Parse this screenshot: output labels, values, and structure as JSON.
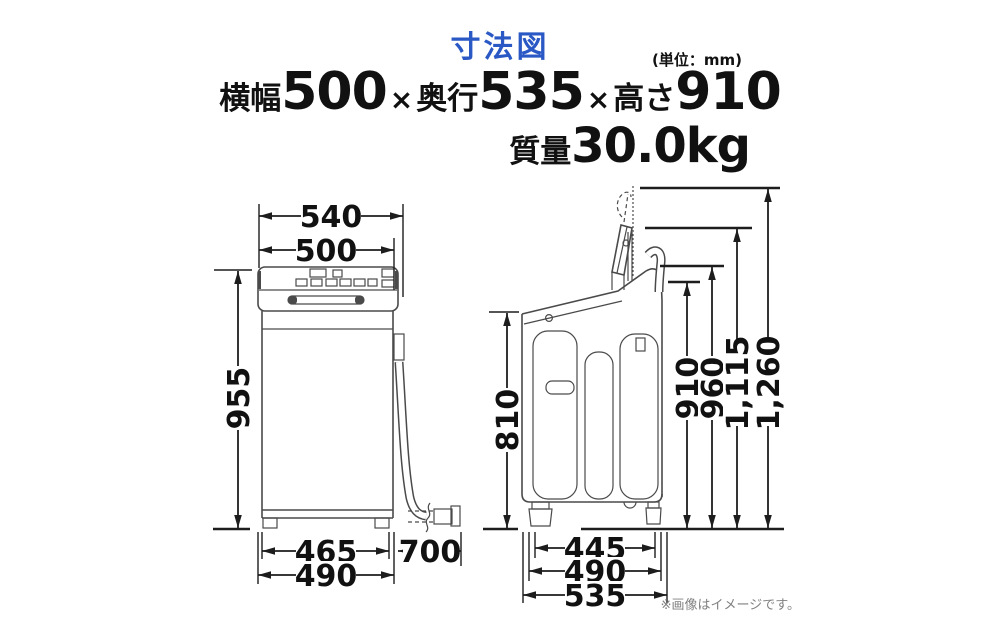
{
  "header": {
    "title": "寸法図",
    "unit_note": "(単位：mm)",
    "spec": {
      "width_label": "横幅",
      "width_value": "500",
      "times1": "×",
      "depth_label": "奥行",
      "depth_value": "535",
      "times2": "×",
      "height_label": "高さ",
      "height_value": "910"
    },
    "mass_label": "質量",
    "mass_value": "30.0kg"
  },
  "front_view": {
    "dims": {
      "top_width": "540",
      "body_width": "500",
      "height": "955",
      "feet_span": "465",
      "base_width": "490",
      "hose_length": "700"
    }
  },
  "side_view": {
    "dims": {
      "floor_height": "810",
      "feet_span": "445",
      "base_depth": "490",
      "total_depth": "535",
      "body_height": "910",
      "hose_height": "960",
      "lid_mid_height": "1,115",
      "lid_top_height": "1,260"
    }
  },
  "footer": {
    "note": "※画像はイメージです。"
  },
  "colors": {
    "title_blue": "#2a58c4",
    "dim_line": "#1d1d1d",
    "machine_line": "#4a4a4a",
    "note_gray": "#808080"
  }
}
